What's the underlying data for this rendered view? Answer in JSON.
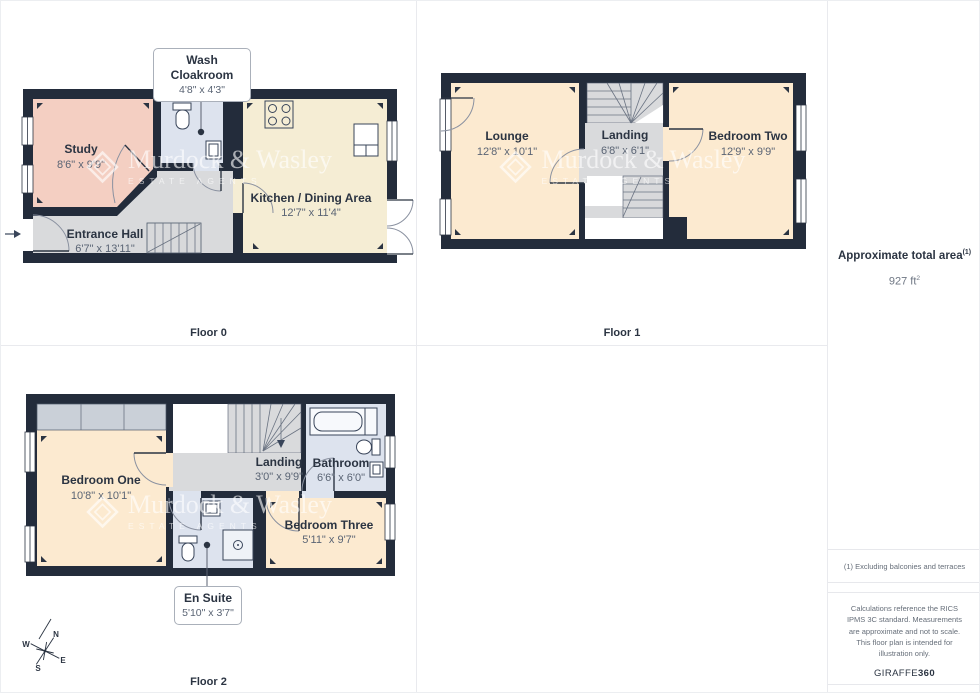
{
  "watermark": {
    "name": "Murdock & Wasley",
    "tagline": "ESTATE AGENTS"
  },
  "floors": [
    {
      "label": "Floor 0",
      "rooms": {
        "study": {
          "name": "Study",
          "dims": "8'6\" x 9'9\""
        },
        "entrance_hall": {
          "name": "Entrance Hall",
          "dims": "6'7\" x 13'11\""
        },
        "kitchen": {
          "name": "Kitchen / Dining Area",
          "dims": "12'7\" x 11'4\""
        }
      },
      "callout": {
        "name": "Wash Cloakroom",
        "dims": "4'8\" x 4'3\""
      }
    },
    {
      "label": "Floor 1",
      "rooms": {
        "lounge": {
          "name": "Lounge",
          "dims": "12'8\" x 10'1\""
        },
        "landing": {
          "name": "Landing",
          "dims": "6'8\" x 6'1\""
        },
        "bedroom_two": {
          "name": "Bedroom Two",
          "dims": "12'9\" x 9'9\""
        }
      }
    },
    {
      "label": "Floor 2",
      "rooms": {
        "bedroom_one": {
          "name": "Bedroom One",
          "dims": "10'8\" x 10'1\""
        },
        "landing": {
          "name": "Landing",
          "dims": "3'0\" x 9'9\""
        },
        "bathroom": {
          "name": "Bathroom",
          "dims": "6'6\" x 6'0\""
        },
        "bedroom_three": {
          "name": "Bedroom Three",
          "dims": "5'11\" x 9'7\""
        }
      },
      "callout": {
        "name": "En Suite",
        "dims": "5'10\" x 3'7\""
      }
    }
  ],
  "compass": {
    "north": "N",
    "east": "E",
    "south": "S",
    "west": "W"
  },
  "sidebar": {
    "area_title": "Approximate total area",
    "area_title_sup": "(1)",
    "area_value": "927 ft",
    "area_value_sup": "2",
    "footnote": "(1) Excluding balconies and terraces",
    "legal": "Calculations reference the RICS IPMS 3C standard. Measurements are approximate and not to scale. This floor plan is intended for illustration only.",
    "brand": "GIRAFFE",
    "brand_bold": "360"
  },
  "colors": {
    "wall": "#232c3b",
    "room_peach": "#fcead0",
    "room_cream": "#f5edd4",
    "room_pink": "#f4cfc2",
    "room_gray": "#d9dadc",
    "room_blue": "#dde3ee",
    "wardrobe_gray": "#cad0d8",
    "label_navy": "#2b3442",
    "dims_gray": "#5a6474",
    "divider": "#e9eaee"
  }
}
